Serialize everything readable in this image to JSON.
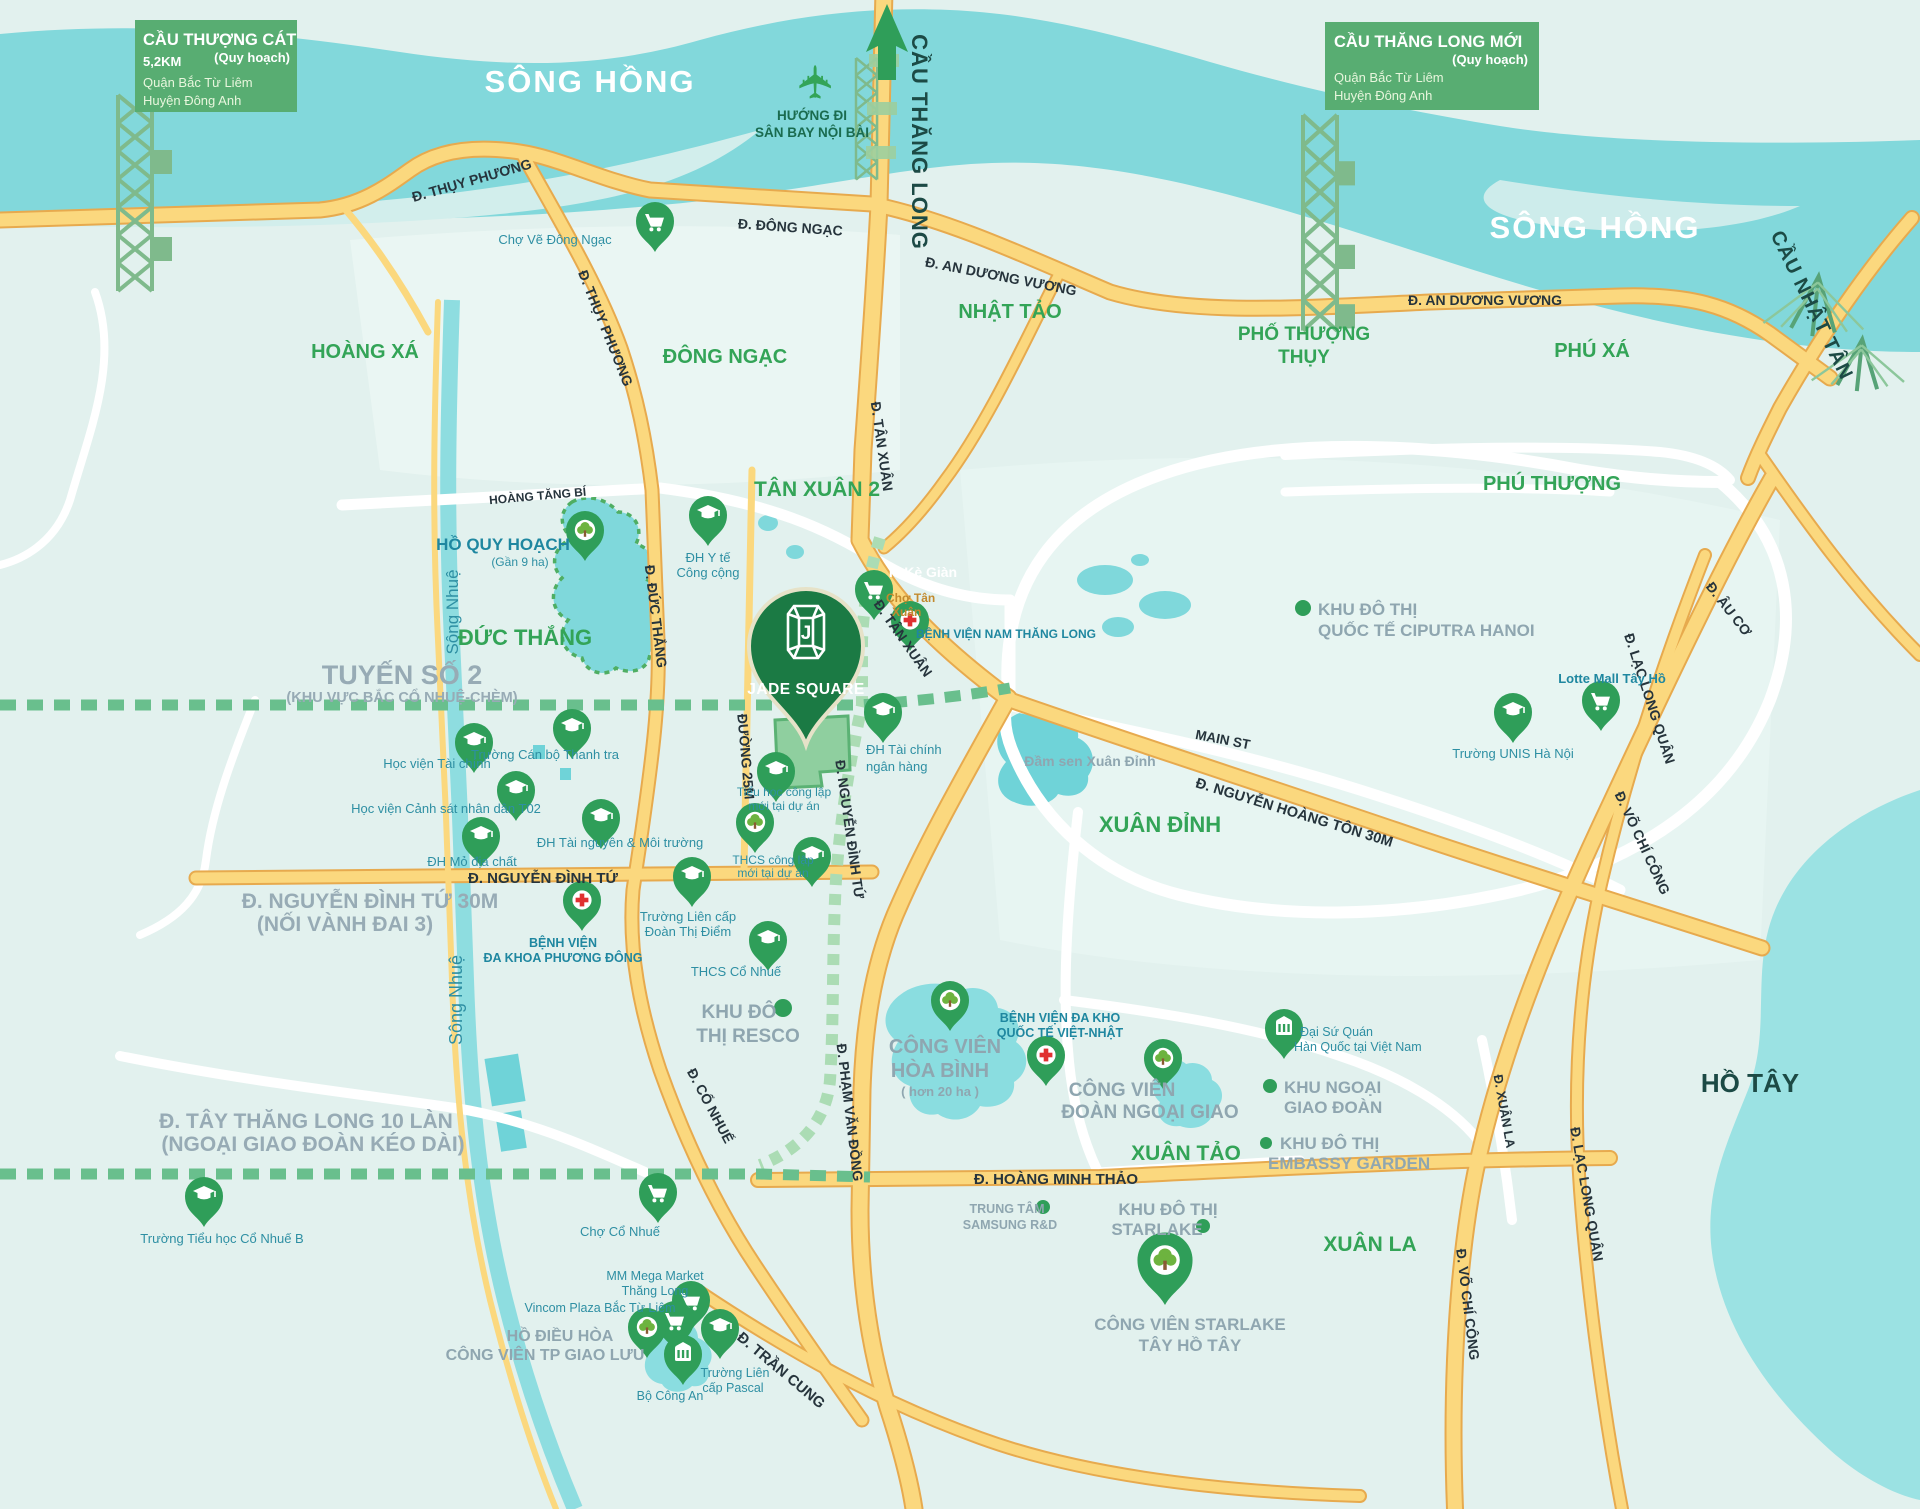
{
  "map": {
    "colors": {
      "accent_green": "#33a457",
      "pin_green": "#2f9e59",
      "jade_green": "#1b7a44",
      "road_yellow": "#fbd87e",
      "water": "#7fd8db",
      "land": "#e2f1ee",
      "gray_label": "#97abb5",
      "dark_label": "#1c4a45",
      "legend_box": "#58ad72"
    },
    "legend_thuong_cat": {
      "title": "CẦU THƯỢNG CÁT",
      "distance": "5,2KM",
      "planning": "(Quy hoạch)",
      "line1": "Quận Bắc Từ Liêm",
      "line2": "Huyện Đông Anh"
    },
    "legend_thang_long_moi": {
      "title": "CẦU THĂNG LONG MỚI",
      "planning": "(Quy hoạch)",
      "line1": "Quận Bắc Từ Liêm",
      "line2": "Huyện Đông Anh"
    },
    "airport": {
      "line1": "HƯỚNG ĐI",
      "line2": "SÂN BAY NỘI BÀI"
    },
    "rivers": {
      "song_hong_1": "SÔNG HỒNG",
      "song_hong_2": "SÔNG HỒNG",
      "song_nhue_1": "Sông Nhuệ",
      "song_nhue_2": "Sông Nhuệ"
    },
    "bridges": {
      "cau_thang_long": "CẦU THĂNG LONG",
      "cau_nhat_tan": "CẦU NHẬT TÂN"
    },
    "areas": {
      "hoang_xa": "HOÀNG XÁ",
      "dong_ngac": "ĐÔNG NGẠC",
      "nhat_tao": "NHẬT TẢO",
      "pho_thuong_thuy_1": "PHỐ THƯỢNG",
      "pho_thuong_thuy_2": "THỤY",
      "phu_xa": "PHÚ XÁ",
      "phu_thuong": "PHÚ THƯỢNG",
      "tan_xuan_2": "TÂN XUÂN 2",
      "duc_thang": "ĐỨC THẮNG",
      "xuan_dinh": "XUÂN ĐỈNH",
      "xuan_tao": "XUÂN TẢO",
      "xuan_la": "XUÂN LA"
    },
    "roads": {
      "thuy_phuong_1": "Đ. THỤY PHƯƠNG",
      "thuy_phuong_2": "Đ. THỤY PHƯƠNG",
      "dong_ngac": "Đ. ĐÔNG NGẠC",
      "an_duong_vuong_1": "Đ. AN DƯƠNG VƯƠNG",
      "an_duong_vuong_2": "Đ. AN DƯƠNG VƯƠNG",
      "hoang_tang_bi": "HOÀNG TĂNG BÍ",
      "duc_thang": "Đ. ĐỨC THẮNG",
      "duong_25m": "ĐƯỜNG 25M",
      "nguyen_dinh_tu_v": "Đ. NGUYỄN ĐÌNH TỨ",
      "nguyen_dinh_tu_h": "Đ. NGUYỄN ĐÌNH TỨ",
      "nguyen_dinh_tu_30m_1": "Đ. NGUYỄN ĐÌNH TỨ 30M",
      "nguyen_dinh_tu_30m_2": "(NỐI VÀNH ĐAI 3)",
      "tan_xuan_v": "Đ. TÂN XUÂN",
      "tan_xuan_d": "Đ. TÂN XUÂN",
      "ke_gian": "P. Kè Giàn",
      "main_st": "MAIN  ST",
      "nguyen_hoang_ton": "Đ. NGUYỄN HOÀNG TÔN 30M",
      "pham_van_dong": "Đ. PHẠM VĂN ĐỒNG",
      "hoang_minh_thao": "Đ. HOÀNG MINH THẢO",
      "co_nhue": "Đ. CỔ NHUẾ",
      "tran_cung": "Đ. TRẦN CUNG",
      "au_co": "Đ. ÂU CƠ",
      "lac_long_quan_1": "Đ. LẠC LONG QUÂN",
      "lac_long_quan_2": "Đ. LẠC LONG QUÂN",
      "vo_chi_cong_1": "Đ. VÕ CHÍ CÔNG",
      "vo_chi_cong_2": "Đ. VÕ CHÍ CÔNG",
      "xuan_la": "Đ. XUÂN LA",
      "tuyen_so_2_1": "TUYẾN SỐ 2",
      "tuyen_so_2_2": "(KHU VỰC BẮC CỔ NHUỆ-CHÈM)",
      "tay_thang_long_1": "Đ. TÂY THĂNG LONG 10 LÀN",
      "tay_thang_long_2": "(NGOẠI GIAO ĐOÀN KÉO DÀI)"
    },
    "lakes": {
      "ho_quy_hoach": "HỒ QUY HOẠCH",
      "ho_quy_hoach_area": "(Gần 9 ha)",
      "dam_sen": "Đầm sen Xuân Đỉnh",
      "ho_tay": "HỒ TÂY"
    },
    "project": {
      "name": "JADE SQUARE",
      "monogram": "J"
    },
    "pois": {
      "cho_ve_dong_ngac": "Chợ Vẽ Đông Ngạc",
      "dh_y_te_1": "ĐH Y tế",
      "dh_y_te_2": "Công cộng",
      "cho_tan_xuan_1": "Chợ Tân",
      "cho_tan_xuan_2": "Xuân",
      "bv_nam_thang_long": "BỆNH VIỆN NAM THĂNG LONG",
      "hoc_vien_tai_chinh": "Học viện Tài chính",
      "truong_can_bo_thanh_tra": "Trường Cán bộ Thanh tra",
      "hoc_vien_canh_sat": "Học viện Cảnh sát nhân dân T02",
      "dh_tai_nguyen": "ĐH Tài nguyên & Môi trường",
      "dh_mo_dia_chat": "ĐH Mỏ địa chất",
      "dh_tai_chinh_1": "ĐH Tài chính",
      "dh_tai_chinh_2": "ngân hàng",
      "tieu_hoc_1": "Tiểu học công lập",
      "tieu_hoc_2": "mới tại dự án",
      "thcs_1": "THCS công lập",
      "thcs_2": "mới tại dự án",
      "bv_phuong_dong_1": "BỆNH VIỆN",
      "bv_phuong_dong_2": "ĐA KHOA PHƯƠNG ĐÔNG",
      "doan_thi_diem_1": "Trường Liên cấp",
      "doan_thi_diem_2": "Đoàn Thị Điểm",
      "thcs_co_nhue": "THCS Cổ Nhuế",
      "resco_1": "KHU ĐÔ",
      "resco_2": "THỊ RESCO",
      "hoa_binh_1": "CÔNG VIÊN",
      "hoa_binh_2": "HÒA BÌNH",
      "hoa_binh_3": "( hơn 20 ha )",
      "viet_nhat_1": "BỆNH VIỆN ĐA KHO",
      "viet_nhat_2": "QUỐC TẾ VIỆT-NHẬT",
      "doan_ngoai_giao_1": "CÔNG VIÊN",
      "doan_ngoai_giao_2": "ĐOÀN NGOẠI GIAO",
      "dai_su_quan_1": "Đại Sứ Quán",
      "dai_su_quan_2": "Hàn Quốc tại Việt Nam",
      "khu_ngoai_giao_1": "KHU NGOẠI",
      "khu_ngoai_giao_2": "GIAO ĐOÀN",
      "embassy_1": "KHU ĐÔ THỊ",
      "embassy_2": "EMBASSY GARDEN",
      "ciputra_1": "KHU ĐÔ THỊ",
      "ciputra_2": "QUỐC TẾ CIPUTRA HANOI",
      "unis": "Trường UNIS Hà Nội",
      "lotte": "Lotte Mall Tây Hồ",
      "co_nhue_b": "Trường Tiểu học Cổ Nhuế B",
      "cho_co_nhue": "Chợ Cổ Nhuế",
      "samsung_1": "TRUNG TÂM",
      "samsung_2": "SAMSUNG R&D",
      "kdt_starlake_1": "KHU ĐÔ THỊ",
      "kdt_starlake_2": "STARLAKE",
      "cv_starlake_1": "CÔNG VIÊN STARLAKE",
      "cv_starlake_2": "TÂY HỒ TÂY",
      "mm_mega_1": "MM Mega Market",
      "mm_mega_2": "Thăng Long",
      "vincom": "Vincom Plaza Bắc Từ Liêm",
      "ho_dieu_hoa_1": "HỒ ĐIỀU HÒA",
      "ho_dieu_hoa_2": "CÔNG VIÊN TP GIAO LƯU",
      "bo_cong_an": "Bộ Công An",
      "pascal_1": "Trường Liên",
      "pascal_2": "cấp Pascal"
    }
  }
}
